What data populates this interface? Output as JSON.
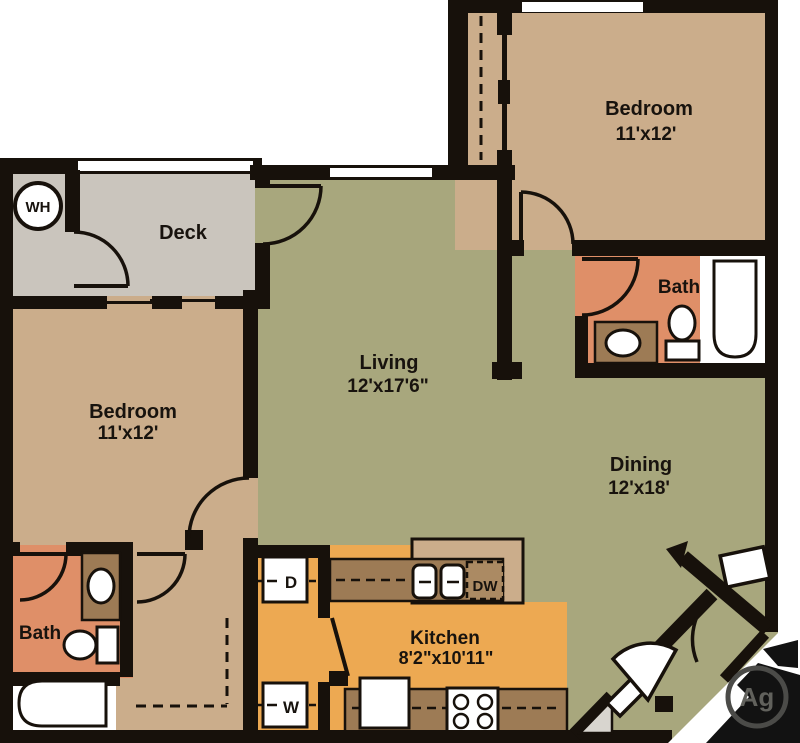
{
  "floorplan": {
    "rooms": {
      "bedroom_top_right": {
        "name": "Bedroom",
        "dims": "11'x12'"
      },
      "bedroom_left": {
        "name": "Bedroom",
        "dims": "11'x12'"
      },
      "living": {
        "name": "Living",
        "dims": "12'x17'6\""
      },
      "dining": {
        "name": "Dining",
        "dims": "12'x18'"
      },
      "kitchen": {
        "name": "Kitchen",
        "dims": "8'2\"x10'11\""
      },
      "deck": {
        "name": "Deck"
      },
      "bath_upper": {
        "name": "Bath"
      },
      "bath_lower": {
        "name": "Bath"
      }
    },
    "labels": {
      "water_heater": "WH",
      "dryer": "D",
      "washer": "W",
      "dishwasher": "DW"
    },
    "watermark": {
      "text": "Ag"
    },
    "colors": {
      "wall": "#17110b",
      "living_dining_floor": "#a8a77d",
      "bedroom_floor": "#cbad8b",
      "bath_floor": "#df8f68",
      "kitchen_floor": "#eda952",
      "deck_floor": "#cac5bd",
      "counter": "#9d7b55",
      "dishwasher_fill": "#ab8a63",
      "entry_pad": "#d8d5cf"
    }
  }
}
